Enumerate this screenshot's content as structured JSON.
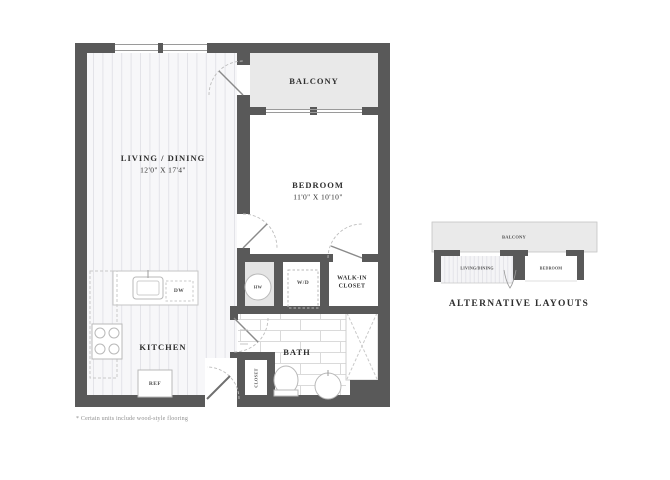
{
  "colors": {
    "wall": "#595959",
    "balcony_fill": "#e9e9e9",
    "utility_fill": "#e4e4e4",
    "text": "#2f2f2f"
  },
  "floorplan": {
    "living_dining": {
      "label": "LIVING / DINING",
      "dimensions": "12'0\" X 17'4\""
    },
    "bedroom": {
      "label": "BEDROOM",
      "dimensions": "11'0\" X 10'10\""
    },
    "balcony": {
      "label": "BALCONY"
    },
    "kitchen": {
      "label": "KITCHEN"
    },
    "bath": {
      "label": "BATH"
    },
    "walk_in_closet": {
      "label": "WALK-IN CLOSET"
    },
    "entry_closet": {
      "label": "CLOSET"
    },
    "appliances": {
      "dishwasher": "DW",
      "refrigerator": "REF",
      "washer_dryer": "W/D",
      "water_heater": "HW"
    }
  },
  "alternative_layouts": {
    "title": "ALTERNATIVE LAYOUTS",
    "balcony_label": "BALCONY",
    "living_label": "LIVING/DINING",
    "bedroom_label": "BEDROOM"
  },
  "footnote": "* Certain units include wood-style flooring"
}
